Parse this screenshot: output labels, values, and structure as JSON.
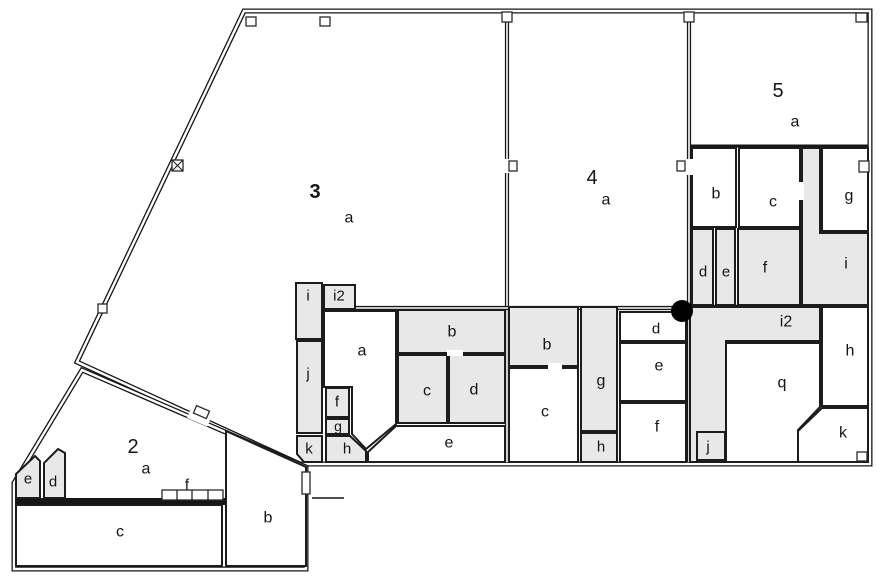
{
  "plan": {
    "canvas": {
      "width": 892,
      "height": 588
    },
    "colors": {
      "background": "#ffffff",
      "wall": "#161616",
      "room_shaded": "#e8e8e8",
      "marker": "#000000"
    },
    "marker": {
      "x": 682,
      "y": 311,
      "r": 11
    },
    "labels": [
      {
        "name": "label-section-2",
        "text": "2",
        "x": 133,
        "y": 447,
        "size": 20,
        "bold": false
      },
      {
        "name": "label-section-2-a",
        "text": "a",
        "x": 146,
        "y": 469,
        "size": 16,
        "bold": false
      },
      {
        "name": "label-section-3",
        "text": "3",
        "x": 315,
        "y": 192,
        "size": 20,
        "bold": true
      },
      {
        "name": "label-section-3-a",
        "text": "a",
        "x": 349,
        "y": 218,
        "size": 16,
        "bold": false
      },
      {
        "name": "label-section-4",
        "text": "4",
        "x": 592,
        "y": 178,
        "size": 20,
        "bold": false
      },
      {
        "name": "label-section-4-a",
        "text": "a",
        "x": 606,
        "y": 200,
        "size": 16,
        "bold": false
      },
      {
        "name": "label-section-5",
        "text": "5",
        "x": 778,
        "y": 91,
        "size": 20,
        "bold": false
      },
      {
        "name": "label-section-5-a",
        "text": "a",
        "x": 795,
        "y": 122,
        "size": 16,
        "bold": false
      },
      {
        "name": "label-room-2e",
        "text": "e",
        "x": 28,
        "y": 479,
        "size": 15,
        "bold": false
      },
      {
        "name": "label-room-2d",
        "text": "d",
        "x": 53,
        "y": 482,
        "size": 15,
        "bold": false
      },
      {
        "name": "label-room-2f",
        "text": "f",
        "x": 187,
        "y": 485,
        "size": 15,
        "bold": false
      },
      {
        "name": "label-room-2c",
        "text": "c",
        "x": 120,
        "y": 532,
        "size": 16,
        "bold": false
      },
      {
        "name": "label-room-2b",
        "text": "b",
        "x": 268,
        "y": 518,
        "size": 16,
        "bold": false
      },
      {
        "name": "label-room-3i",
        "text": "i",
        "x": 308,
        "y": 296,
        "size": 15,
        "bold": false
      },
      {
        "name": "label-room-3i2",
        "text": "i2",
        "x": 339,
        "y": 296,
        "size": 15,
        "bold": false
      },
      {
        "name": "label-room-3a2",
        "text": "a",
        "x": 362,
        "y": 351,
        "size": 16,
        "bold": false
      },
      {
        "name": "label-room-3j",
        "text": "j",
        "x": 308,
        "y": 374,
        "size": 15,
        "bold": false
      },
      {
        "name": "label-room-3f",
        "text": "f",
        "x": 337,
        "y": 402,
        "size": 15,
        "bold": false
      },
      {
        "name": "label-room-3g",
        "text": "g",
        "x": 338,
        "y": 426,
        "size": 14,
        "bold": false
      },
      {
        "name": "label-room-3k",
        "text": "k",
        "x": 309,
        "y": 449,
        "size": 15,
        "bold": false
      },
      {
        "name": "label-room-3h",
        "text": "h",
        "x": 347,
        "y": 449,
        "size": 15,
        "bold": false
      },
      {
        "name": "label-room-3b",
        "text": "b",
        "x": 452,
        "y": 332,
        "size": 16,
        "bold": false
      },
      {
        "name": "label-room-3c",
        "text": "c",
        "x": 427,
        "y": 391,
        "size": 16,
        "bold": false
      },
      {
        "name": "label-room-3d",
        "text": "d",
        "x": 474,
        "y": 390,
        "size": 16,
        "bold": false
      },
      {
        "name": "label-room-3e",
        "text": "e",
        "x": 449,
        "y": 443,
        "size": 16,
        "bold": false
      },
      {
        "name": "label-room-4b",
        "text": "b",
        "x": 547,
        "y": 345,
        "size": 16,
        "bold": false
      },
      {
        "name": "label-room-4c",
        "text": "c",
        "x": 545,
        "y": 412,
        "size": 16,
        "bold": false
      },
      {
        "name": "label-room-4g",
        "text": "g",
        "x": 601,
        "y": 381,
        "size": 16,
        "bold": false
      },
      {
        "name": "label-room-4h",
        "text": "h",
        "x": 601,
        "y": 447,
        "size": 15,
        "bold": false
      },
      {
        "name": "label-room-4d",
        "text": "d",
        "x": 656,
        "y": 329,
        "size": 15,
        "bold": false
      },
      {
        "name": "label-room-4e",
        "text": "e",
        "x": 659,
        "y": 366,
        "size": 16,
        "bold": false
      },
      {
        "name": "label-room-4f",
        "text": "f",
        "x": 657,
        "y": 427,
        "size": 16,
        "bold": false
      },
      {
        "name": "label-room-5j",
        "text": "j",
        "x": 708,
        "y": 447,
        "size": 15,
        "bold": false
      },
      {
        "name": "label-room-5q",
        "text": "q",
        "x": 782,
        "y": 383,
        "size": 16,
        "bold": false
      },
      {
        "name": "label-room-5i2",
        "text": "i2",
        "x": 786,
        "y": 322,
        "size": 16,
        "bold": false
      },
      {
        "name": "label-room-5h",
        "text": "h",
        "x": 850,
        "y": 351,
        "size": 16,
        "bold": false
      },
      {
        "name": "label-room-5k",
        "text": "k",
        "x": 843,
        "y": 433,
        "size": 16,
        "bold": false
      },
      {
        "name": "label-room-5b",
        "text": "b",
        "x": 716,
        "y": 194,
        "size": 16,
        "bold": false
      },
      {
        "name": "label-room-5c",
        "text": "c",
        "x": 773,
        "y": 202,
        "size": 16,
        "bold": false
      },
      {
        "name": "label-room-5g",
        "text": "g",
        "x": 849,
        "y": 196,
        "size": 16,
        "bold": false
      },
      {
        "name": "label-room-5d",
        "text": "d",
        "x": 703,
        "y": 272,
        "size": 15,
        "bold": false
      },
      {
        "name": "label-room-5e",
        "text": "e",
        "x": 726,
        "y": 272,
        "size": 15,
        "bold": false
      },
      {
        "name": "label-room-5f",
        "text": "f",
        "x": 765,
        "y": 268,
        "size": 16,
        "bold": false
      },
      {
        "name": "label-room-5i",
        "text": "i",
        "x": 846,
        "y": 264,
        "size": 16,
        "bold": false
      }
    ]
  }
}
